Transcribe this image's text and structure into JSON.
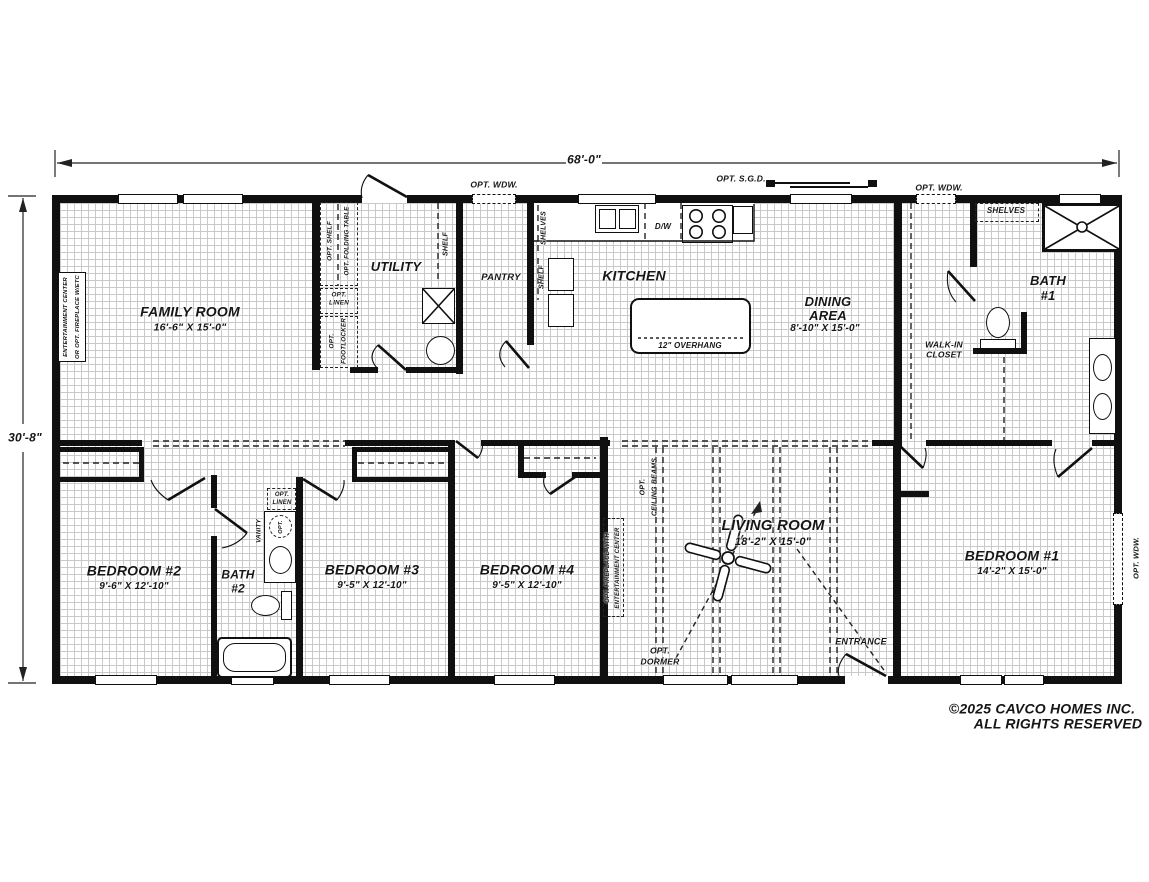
{
  "dims": {
    "width": "68'-0\"",
    "height": "30'-8\""
  },
  "rooms": {
    "family_room": {
      "name": "FAMILY ROOM",
      "size": "16'-6\" X 15'-0\""
    },
    "utility": {
      "name": "UTILITY"
    },
    "pantry": {
      "name": "PANTRY"
    },
    "kitchen": {
      "name": "KITCHEN"
    },
    "dining": {
      "line1": "DINING",
      "line2": "AREA",
      "size": "8'-10\" X 15'-0\""
    },
    "bath1": {
      "line1": "BATH",
      "line2": "#1"
    },
    "walk_in": {
      "line1": "WALK-IN",
      "line2": "CLOSET"
    },
    "bedroom2": {
      "name": "BEDROOM #2",
      "size": "9'-6\" X 12'-10\""
    },
    "bath2": {
      "line1": "BATH",
      "line2": "#2"
    },
    "bedroom3": {
      "name": "BEDROOM #3",
      "size": "9'-5\" X 12'-10\""
    },
    "bedroom4": {
      "name": "BEDROOM #4",
      "size": "9'-5\" X 12'-10\""
    },
    "living": {
      "name": "LIVING ROOM",
      "size": "18'-2\" X 15'-0\""
    },
    "bedroom1": {
      "name": "BEDROOM #1",
      "size": "14'-2\" X 15'-0\""
    }
  },
  "ann": {
    "opt_wdw": "OPT. WDW.",
    "opt_sgd": "OPT. S.G.D.",
    "shelf": "SHELF",
    "shelves": "SHELVES",
    "opt_shelf": "OPT. SHELF",
    "opt_folding": "OPT. FOLDING TABLE",
    "opt": "OPT.",
    "linen": "LINEN",
    "footlocker": "FOOTLOCKER",
    "dw": "D/W",
    "overhang": "12\" OVERHANG",
    "ent1": "ENTERTAINMENT CENTER",
    "ent2": "OR OPT. FIREPLACE W/ETC",
    "vanity": "VANITY",
    "beams2": "CEILING BEAMS",
    "fire1": "OPT. FIREPLACE WITH",
    "fire2": "ENTERTAINMENT CENTER",
    "dormer2": "DORMER",
    "entrance": "ENTRANCE"
  },
  "footer": {
    "line1": "©2025 CAVCO HOMES INC.",
    "line2": "ALL RIGHTS RESERVED"
  }
}
